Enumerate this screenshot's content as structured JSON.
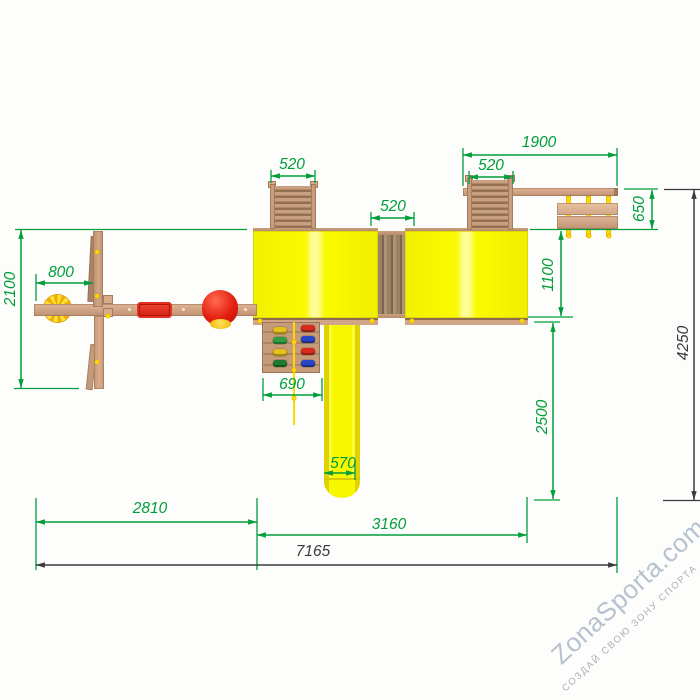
{
  "dimensions": {
    "swing_depth": "2100",
    "swing_offset": "800",
    "ladder_left": "520",
    "bridge_width": "520",
    "ladder_right": "520",
    "overhead_beam": "1900",
    "bench_depth": "650",
    "bench_to_tower": "1100",
    "climb_wall": "690",
    "slide_run": "2500",
    "slide_width": "570",
    "section_swing": "2810",
    "section_towers": "3160",
    "total_width": "7165",
    "total_depth": "4250"
  },
  "watermark": {
    "brand": "ZonaSporta.com",
    "tagline": "СОЗДАЙ СВОЮ ЗОНУ СПОРТА"
  },
  "colors": {
    "dimension_green": "#009e3a",
    "dimension_dark": "#3b3b3b",
    "roof_yellow": "#f8f800",
    "wood_light": "#d2a586",
    "seat_red": "#e03020",
    "accent_yellow": "#ffd900"
  }
}
